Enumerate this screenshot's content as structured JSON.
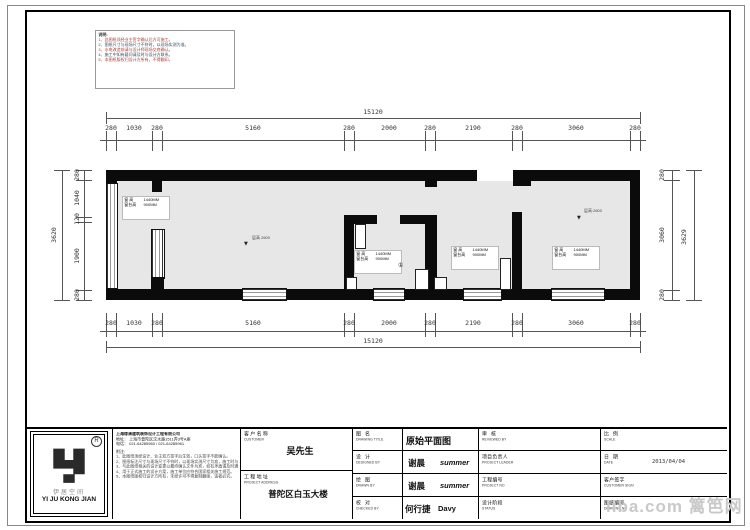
{
  "dimensions": {
    "top": {
      "overall": "15120",
      "segments": [
        "280",
        "1030",
        "280",
        "5160",
        "280",
        "2000",
        "280",
        "2190",
        "280",
        "3060",
        "280"
      ]
    },
    "bottom": {
      "overall": "15120",
      "segments": [
        "280",
        "1030",
        "280",
        "5160",
        "280",
        "2000",
        "280",
        "2190",
        "280",
        "3060",
        "280"
      ]
    },
    "left": {
      "overall": "3620",
      "segments": [
        "280",
        "1040",
        "120",
        "1900",
        "280"
      ]
    },
    "right": {
      "overall": "3629",
      "segments": [
        "280",
        "3060",
        "280"
      ]
    }
  },
  "plan": {
    "window_label": {
      "r1l": "窗 高",
      "r1v": "1440MM",
      "r2l": "窗台高",
      "r2v": "900MM"
    },
    "height_left": "层高 2600",
    "height_right": "层高:2600",
    "level_marker": "▼",
    "marker": "①"
  },
  "corner_notes": {
    "lines": [
      "说明:",
      "1、此图纸须经业主签字确认后方可施工。",
      "2、图纸尺寸与现场尺寸不符时，以现场实测为准。",
      "3、水电改造前请与设计师现场交底确认。",
      "4、施工中如有疑问请及时与设计方联系。",
      "5、本图纸版权归设计方所有，不得翻印。"
    ]
  },
  "company": {
    "name": "上海缘清建筑装饰设计工程有限公司",
    "address": "地址： 上海市普陀区汶水路1511弄3号A座",
    "phone": "电话： 021-64285960 / 021-64285961",
    "notes_title": "附注:",
    "notes": [
      "1、此图纸须经设计、业主双方签字后生效，口头签字不能确认。",
      "2、图纸标注尺寸与现场尺寸不符时，以现场实测尺寸为准，施工时与设计方联系。",
      "3、与此图纸相关的设计变更以最终确认文件为准，如有矛盾请及时通知设计方。",
      "4、用于正式施工的设计方案，施工单位应符合国家相关施工规范。",
      "5、本图纸版权归设计方所有，未经许可不得复制翻版，违者必究。"
    ]
  },
  "logo": {
    "reg": "R",
    "cn": "伊居空间",
    "en": "YI JU KONG JIAN"
  },
  "title_block": {
    "customer_label": "客户名称",
    "customer_label_en": "CUSTOMER",
    "customer_value": "吴先生",
    "address_label": "工程地址",
    "address_label_en": "PROJECT ADDRESS",
    "address_value": "普陀区白玉大楼",
    "drawing_title_label": "图  名",
    "drawing_title_label_en": "DRAWING TITLE",
    "drawing_title_value": "原始平面图",
    "designed_label": "设  计",
    "designed_label_en": "DESIGNED BY",
    "designed_value_cn": "谢晨",
    "designed_value_en": "summer",
    "drawn_label": "绘  图",
    "drawn_label_en": "DRAWN BY",
    "drawn_value_cn": "谢晨",
    "drawn_value_en": "summer",
    "checked_label": "校  对",
    "checked_label_en": "CHECKED BY",
    "checked_value_cn": "何行捷",
    "checked_value_en": "Davy",
    "reviewed_label": "审  核",
    "reviewed_label_en": "REVIEWED BY",
    "leader_label": "项目负责人",
    "leader_label_en": "PROJECT LEADER",
    "project_no_label": "工程编号",
    "project_no_label_en": "PROJECT NO",
    "status_label": "设计阶段",
    "status_label_en": "STATUS",
    "scale_label": "比  例",
    "scale_label_en": "SCALE",
    "date_label": "日  期",
    "date_label_en": "DATE",
    "date_value": "2013/04/04",
    "sign_label": "客户签字",
    "sign_label_en": "CUSTOMER SIGN",
    "drawing_no_label": "图纸编号",
    "drawing_no_label_en": "DRAWING NO"
  },
  "watermark": {
    "text": "liba.com 篱笆网"
  }
}
